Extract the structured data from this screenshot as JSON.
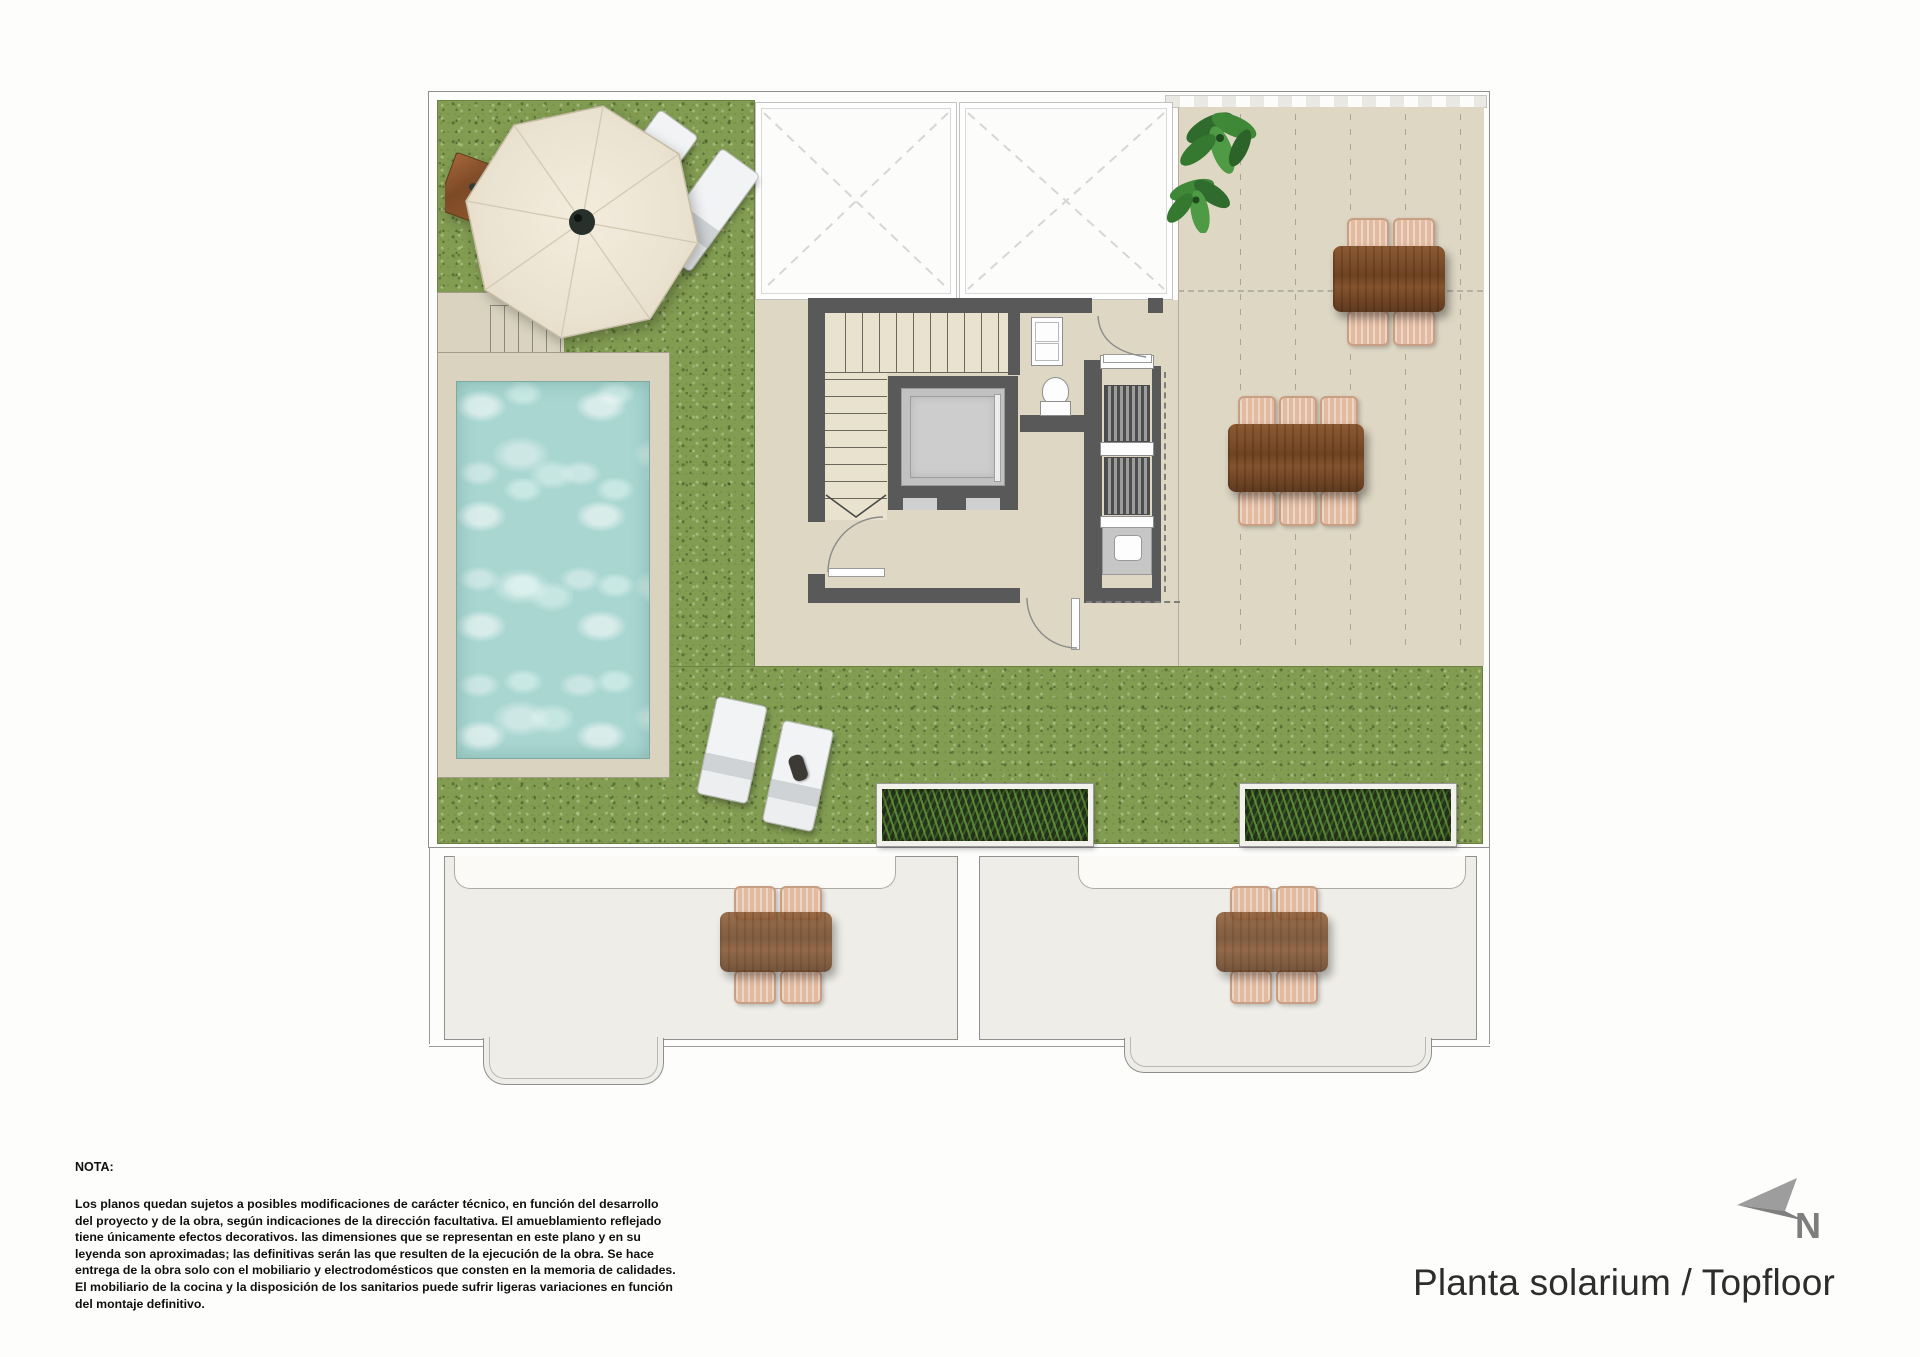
{
  "title": {
    "text": "Planta solarium / Topfloor"
  },
  "north": {
    "label": "N"
  },
  "note": {
    "heading": "NOTA:",
    "lines": [
      "Los planos quedan sujetos a posibles modificaciones de carácter técnico, en función del desarrollo",
      "del proyecto y de la obra, según indicaciones de la dirección facultativa. El amueblamiento reflejado",
      "tiene únicamente efectos decorativos. las dimensiones que se representan en este plano y en su",
      "leyenda son aproximadas; las definitivas serán las que resulten de la ejecución de la obra. Se hace",
      "entrega de la obra solo con el mobiliario y electrodomésticos que consten en la memoria de calidades.",
      "El mobiliario de la cocina y la disposición de los sanitarios puede sufrir ligeras variaciones en función",
      "del montaje definitivo."
    ]
  },
  "plan": {
    "areas": [
      "solarium-lawn",
      "swimming-pool",
      "pool-deck",
      "roof-terrace",
      "stair-core",
      "elevator",
      "wc",
      "outdoor-kitchen",
      "skylight-voids",
      "lower-terrace-left",
      "lower-terrace-right"
    ],
    "furniture": [
      "cantilever-parasol",
      "sun-lounger",
      "sun-lounger",
      "sun-lounger",
      "sun-lounger",
      "dining-table-4-seats",
      "dining-table-6-seats",
      "lower-table-4-seats",
      "lower-table-4-seats",
      "grass-planter",
      "grass-planter",
      "potted-plant"
    ]
  },
  "colors": {
    "grass": "#829c52",
    "terrace": "#ded7c4",
    "pool_water": "#a9d6d1",
    "wall": "#595959",
    "wood": "#7f4e2a",
    "chair": "#e2baa0",
    "lounger": "#eceeef",
    "lower_floor": "#efede8",
    "north_arrow": "#8f8f8f",
    "text": "#2d2d2d"
  }
}
